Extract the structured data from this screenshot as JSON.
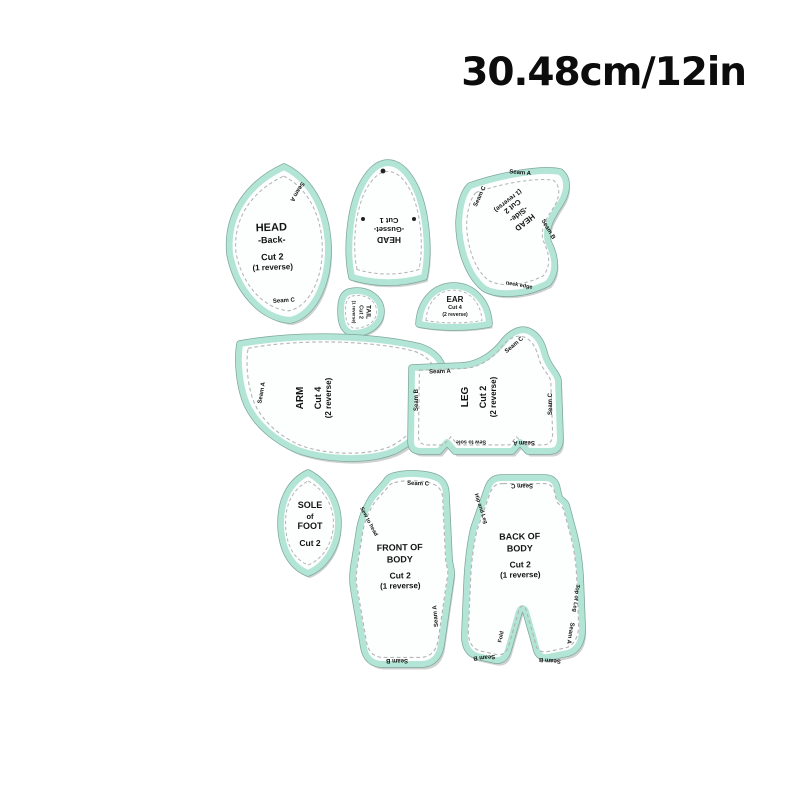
{
  "header": {
    "size_label": "30.48cm/12in"
  },
  "pieces": {
    "head_back": {
      "title": "HEAD",
      "subtitle": "-Back-",
      "cut": "Cut 2",
      "note": "(1 reverse)",
      "seam_top": "Seam A",
      "seam_bottom": "Seam C"
    },
    "head_gusset": {
      "title": "HEAD",
      "subtitle": "-Gusset-",
      "cut": "Cut 1"
    },
    "head_side": {
      "title": "HEAD",
      "subtitle": "-Side-",
      "cut": "Cut 2",
      "note": "(1 reverse)",
      "seam_top": "Seam A",
      "seam_left": "Seam C",
      "seam_right": "Seam B",
      "edge_bottom": "neck edge"
    },
    "tail": {
      "title": "TAIL",
      "cut": "Cut 2",
      "note": "(1 reverse)"
    },
    "ear": {
      "title": "EAR",
      "cut": "Cut 4",
      "note": "(2 reverse)"
    },
    "arm": {
      "title": "ARM",
      "cut": "Cut 4",
      "note": "(2 reverse)",
      "seam_left": "Seam A"
    },
    "leg": {
      "title": "LEG",
      "cut": "Cut 2",
      "note": "(2 reverse)",
      "seam_top": "Seam A",
      "seam_curve": "Seam C",
      "seam_left": "Seam B",
      "seam_right": "Seam C",
      "seam_bottom": "Seam A",
      "edge_bottom": "Sew to sole"
    },
    "sole": {
      "title_line1": "SOLE",
      "title_line2": "of",
      "title_line3": "FOOT",
      "cut": "Cut 2"
    },
    "front_body": {
      "title_line1": "FRONT OF",
      "title_line2": "BODY",
      "cut": "Cut 2",
      "note": "(1 reverse)",
      "seam_top": "Seam C",
      "seam_bottom": "Seam B",
      "seam_right": "Seam A",
      "edge_left": "Sew to head"
    },
    "back_body": {
      "title_line1": "BACK OF",
      "title_line2": "BODY",
      "cut": "Cut 2",
      "note": "(1 reverse)",
      "seam_top": "Seam C",
      "seam_bottom_left": "Seam B",
      "seam_bottom_right": "Seam B",
      "seam_right": "Seam A",
      "edge_left": "Hip and Leg",
      "edge_right": "Top of Leg",
      "fold": "Fold"
    }
  },
  "colors": {
    "background": "#ffffff",
    "piece_fill": "#fdfefe",
    "border_mint": "#b2e5d5",
    "border_rim": "#7ea89b",
    "stitch": "#b4b4b4",
    "shadow": "#cdd1d0",
    "text": "#141414"
  }
}
